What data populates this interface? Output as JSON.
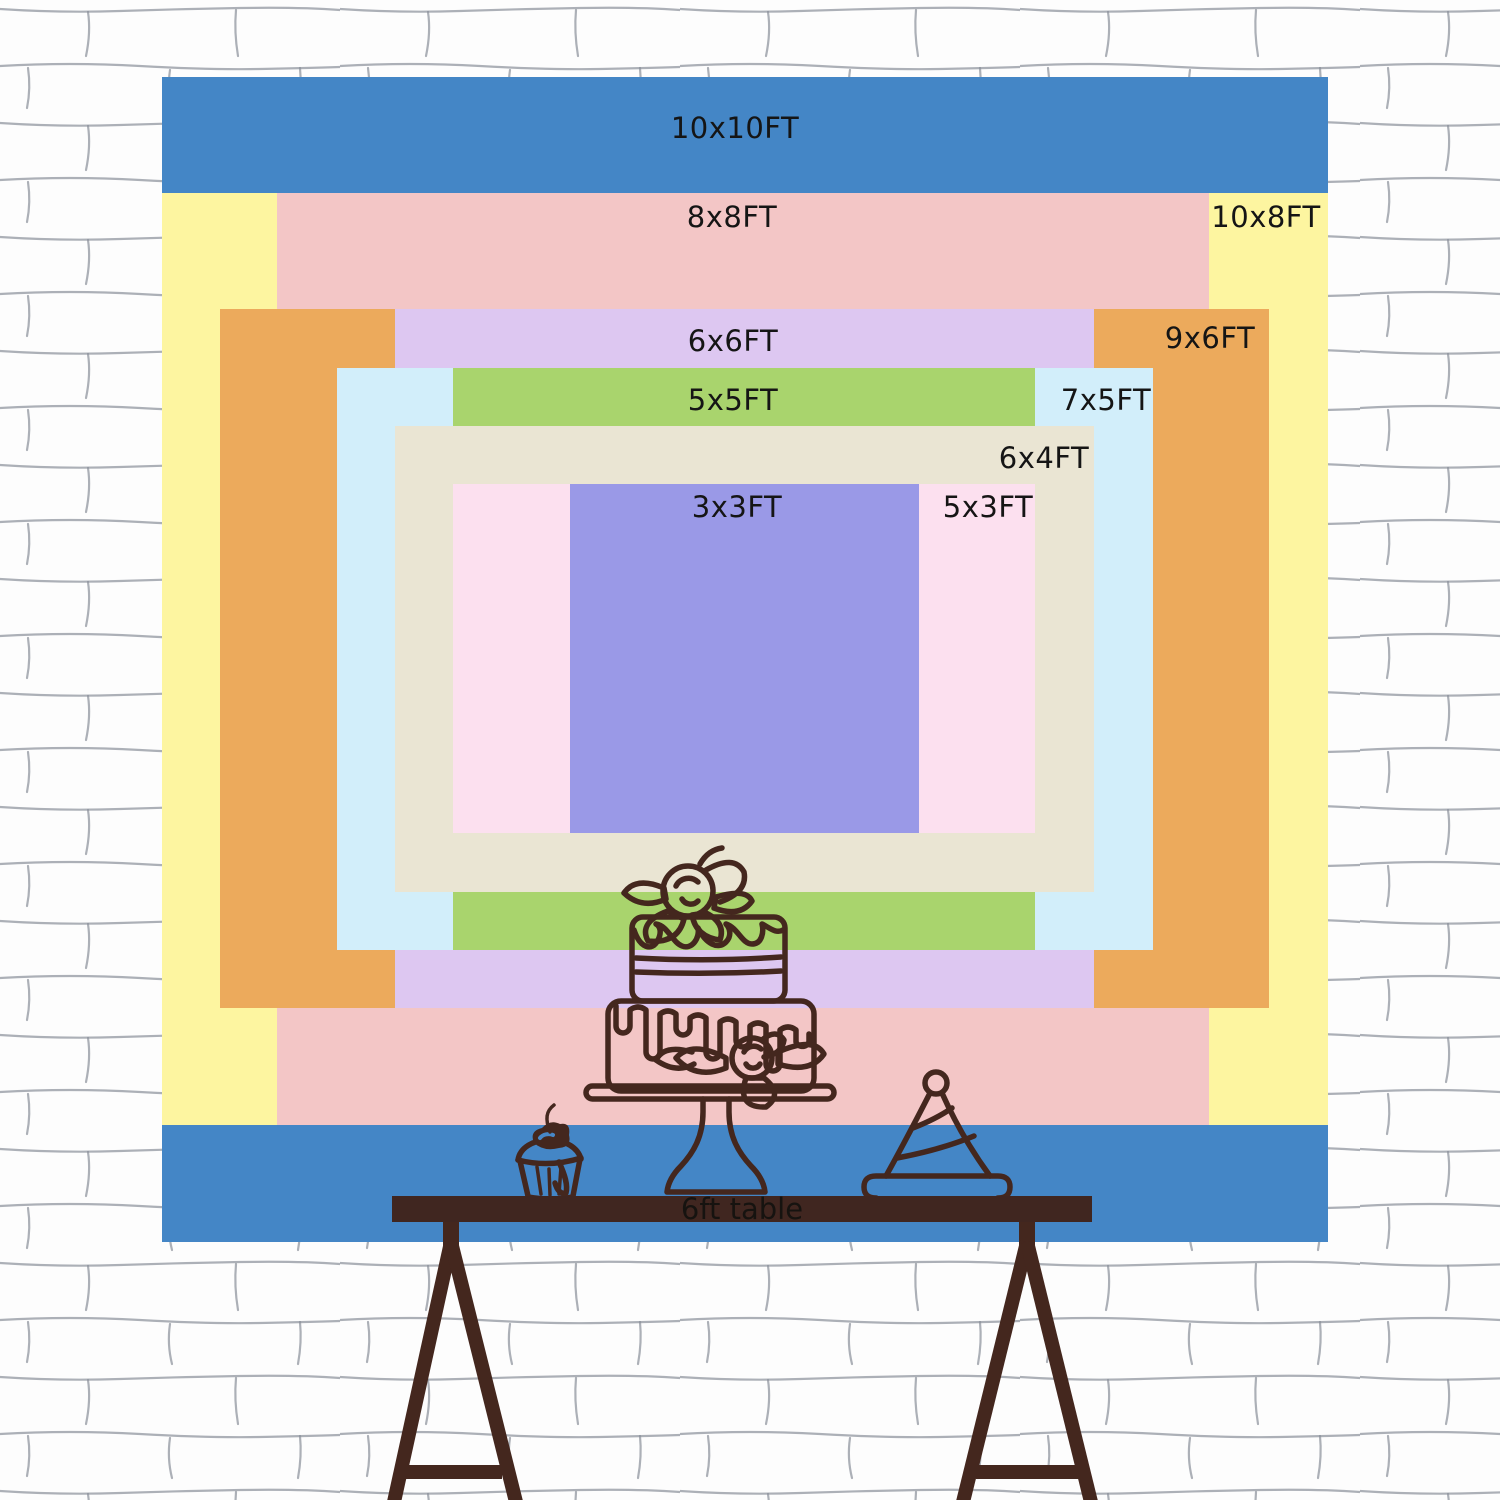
{
  "backdrop": {
    "description": "nested backdrop size comparison chart",
    "text_color": "#151515",
    "sizes": [
      {
        "label": "10x10FT",
        "width_ft": 10,
        "height_ft": 10,
        "color": "#4486c6",
        "label_align": "center"
      },
      {
        "label": "10x8FT",
        "width_ft": 10,
        "height_ft": 8,
        "color": "#fdf5a0",
        "label_align": "right"
      },
      {
        "label": "8x8FT",
        "width_ft": 8,
        "height_ft": 8,
        "color": "#f3c6c6",
        "label_align": "center"
      },
      {
        "label": "9x6FT",
        "width_ft": 9,
        "height_ft": 6,
        "color": "#ecaa5c",
        "label_align": "right"
      },
      {
        "label": "6x6FT",
        "width_ft": 6,
        "height_ft": 6,
        "color": "#ddc7f1",
        "label_align": "center"
      },
      {
        "label": "7x5FT",
        "width_ft": 7,
        "height_ft": 5,
        "color": "#d2eefa",
        "label_align": "right"
      },
      {
        "label": "5x5FT",
        "width_ft": 5,
        "height_ft": 5,
        "color": "#a9d46d",
        "label_align": "center"
      },
      {
        "label": "6x4FT",
        "width_ft": 6,
        "height_ft": 4,
        "color": "#eae5d3",
        "label_align": "right"
      },
      {
        "label": "5x3FT",
        "width_ft": 5,
        "height_ft": 3,
        "color": "#fce0ef",
        "label_align": "right"
      },
      {
        "label": "3x3FT",
        "width_ft": 3,
        "height_ft": 3,
        "color": "#9a99e7",
        "label_align": "center"
      }
    ]
  },
  "table": {
    "label": "6ft table",
    "bar_color": "#402620"
  },
  "art": {
    "outline_color": "#44271e",
    "items": [
      "tiered-cake",
      "cupcake",
      "party-hat",
      "trestle-table-legs"
    ]
  },
  "wall": {
    "brick_color": "#fdfdfd",
    "mortar_line_color": "#8b909a"
  }
}
